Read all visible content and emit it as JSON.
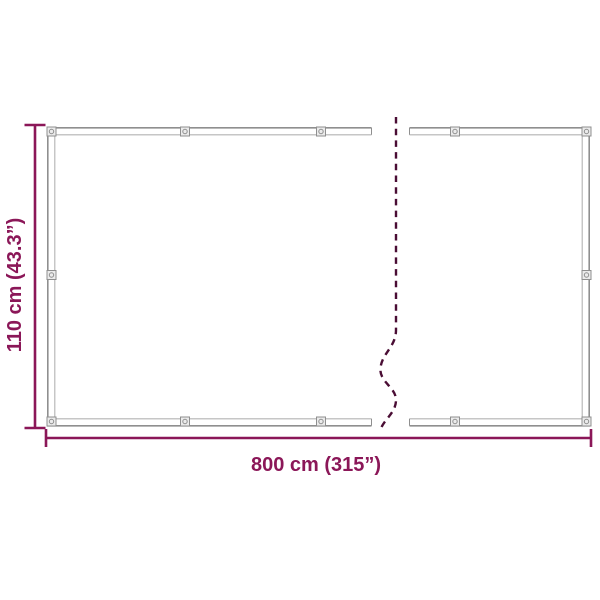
{
  "colors": {
    "dimension": "#8B1758",
    "dash": "#4A0D34",
    "frame": "#8F8F8F",
    "frame-inner": "#B3B3B3",
    "grommet-fill": "#EBEBEB",
    "grommet-stroke": "#8F8F8F",
    "background": "#FFFFFF"
  },
  "diagram": {
    "height_label": "110 cm (43.3”)",
    "width_label": "800 cm (315”)"
  }
}
